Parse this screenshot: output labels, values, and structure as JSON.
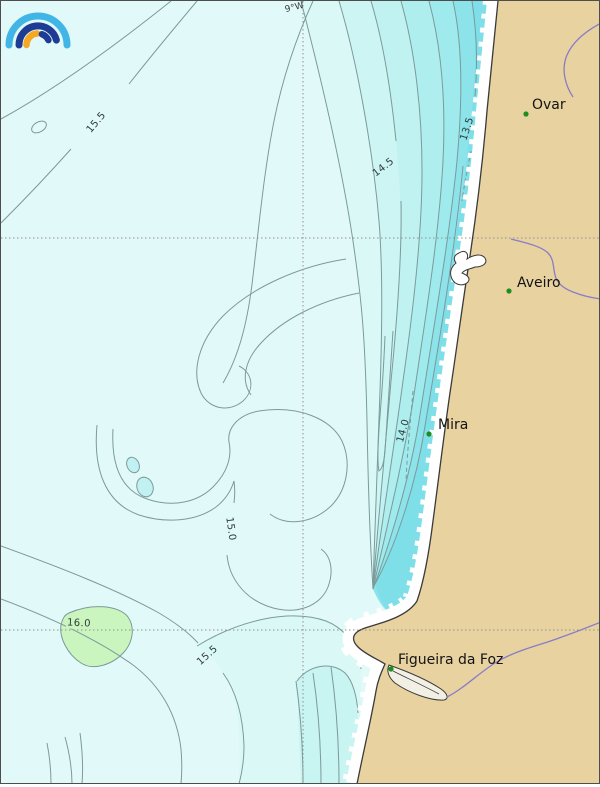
{
  "title": "Coastal contour map — Portugal (Ovar to Figueira da Foz)",
  "meridian_label": "9°W",
  "logo": {
    "name": "ipma-arcs-logo",
    "arc_colors": {
      "outer": "#41B6E6",
      "dark": "#1F3C94",
      "orange": "#F6A723"
    }
  },
  "cities": [
    {
      "name": "Ovar"
    },
    {
      "name": "Aveiro"
    },
    {
      "name": "Mira"
    },
    {
      "name": "Figueira da Foz"
    }
  ],
  "contour_labels": [
    {
      "text": "15.5"
    },
    {
      "text": "14.5"
    },
    {
      "text": "13.5"
    },
    {
      "text": "14.0"
    },
    {
      "text": "15.0"
    },
    {
      "text": "16.0"
    },
    {
      "text": "15.5"
    }
  ],
  "colors": {
    "land": "#E7D2A0",
    "water": "#E1FAF9",
    "beach": "#FFFFFF",
    "coastline": "#3A3A3A",
    "contour_line": "#7C9A9A",
    "river": "#8A7BC8",
    "city_dot": "#1E8E1E",
    "green_area": "#CBF5BE",
    "gridline": "#909090",
    "water_bands": [
      "#D9F8F6",
      "#CDF5F3",
      "#BFF2F1",
      "#AFEEEF",
      "#9EEAEC",
      "#8CE4EA",
      "#7EDFE8"
    ]
  },
  "map_data": {
    "type": "contour",
    "isoline_values": [
      13.5,
      14.0,
      14.5,
      15.0,
      15.5,
      16.0
    ],
    "isoline_trend": "values decrease toward the coast (13.5 nearshore, 16.0 offshore-south)",
    "gridlines": {
      "meridian_label": "9°W",
      "meridian_x_px": 302,
      "parallel_y_px": [
        237,
        629
      ]
    }
  }
}
